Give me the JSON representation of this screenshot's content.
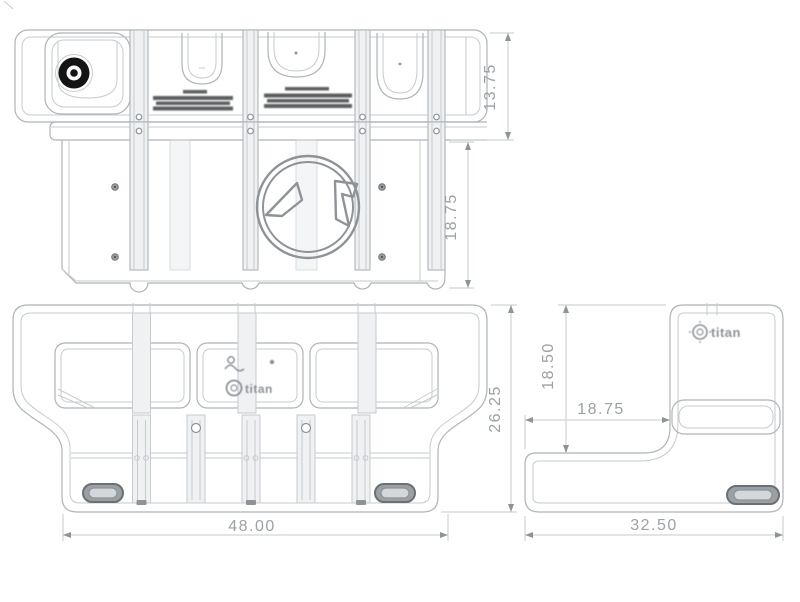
{
  "drawing": {
    "type": "technical-drawing",
    "views": {
      "top": {
        "dim_depth": "13.75"
      },
      "front": {
        "dim_height": "18.75"
      },
      "bottom": {
        "dim_depth": "26.25",
        "dim_width": "48.00"
      },
      "end": {
        "dim_upper_height": "18.50",
        "dim_step_depth": "18.75",
        "dim_width": "32.50"
      }
    },
    "brand": {
      "logo_text": "titan"
    },
    "colors": {
      "background": "#ffffff",
      "line": "#aeb4b8",
      "line_light": "#c6cbce",
      "line_dark": "#8d9397",
      "shade": "#eff1f2",
      "dim_text": "#9ba1a5",
      "cap": "#141414",
      "warning_ink": "#43474a",
      "plug_fill": "#9aa0a4",
      "plug_inner": "#d3d7d9"
    }
  }
}
